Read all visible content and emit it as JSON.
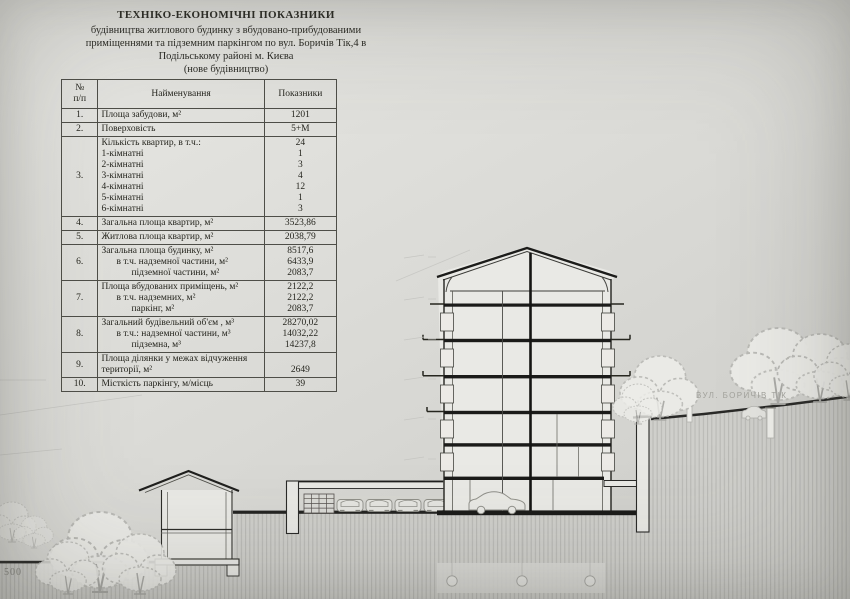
{
  "title": {
    "lines": [
      "ТЕХНІКО-ЕКОНОМІЧНІ ПОКАЗНИКИ",
      "будівництва житлового будинку з вбудовано-прибудованими",
      "приміщеннями та підземним паркінгом по вул. Боричів Тік,4 в",
      "Подільському районі м. Києва",
      "(нове будівництво)"
    ]
  },
  "table": {
    "headers": {
      "no": "№\nп/п",
      "name": "Найменування",
      "value": "Показники"
    },
    "rows": [
      {
        "no": "1.",
        "lines": [
          {
            "label": "Площа забудови, м²",
            "value": "1201"
          }
        ]
      },
      {
        "no": "2.",
        "lines": [
          {
            "label": "Поверховість",
            "value": "5+М"
          }
        ]
      },
      {
        "no": "3.",
        "lines": [
          {
            "label": "Кількість квартир, в т.ч.:",
            "value": "24"
          },
          {
            "label": "1-кімнатні",
            "value": "1"
          },
          {
            "label": "2-кімнатні",
            "value": "3"
          },
          {
            "label": "3-кімнатні",
            "value": "4"
          },
          {
            "label": "4-кімнатні",
            "value": "12"
          },
          {
            "label": "5-кімнатні",
            "value": "1"
          },
          {
            "label": "6-кімнатні",
            "value": "3"
          }
        ]
      },
      {
        "no": "4.",
        "lines": [
          {
            "label": "Загальна площа квартир, м²",
            "value": "3523,86"
          }
        ]
      },
      {
        "no": "5.",
        "lines": [
          {
            "label": "Житлова площа квартир, м²",
            "value": "2038,79"
          }
        ]
      },
      {
        "no": "6.",
        "lines": [
          {
            "label": "Загальна площа будинку, м²",
            "value": "8517,6"
          },
          {
            "label": "в т.ч. надземної частини, м²",
            "value": "6433,9",
            "indent": 1
          },
          {
            "label": "підземної частини, м²",
            "value": "2083,7",
            "indent": 2
          }
        ]
      },
      {
        "no": "7.",
        "lines": [
          {
            "label": "Площа вбудованих приміщень, м²",
            "value": "2122,2"
          },
          {
            "label": "в т.ч. надземних, м²",
            "value": "2122,2",
            "indent": 1
          },
          {
            "label": "паркінг, м²",
            "value": "2083,7",
            "indent": 2
          }
        ]
      },
      {
        "no": "8.",
        "lines": [
          {
            "label": "Загальний будівельний об'єм , м³",
            "value": "28270,02"
          },
          {
            "label": "в т.ч.: надземної частини, м³",
            "value": "14032,22",
            "indent": 1
          },
          {
            "label": "підземна, м³",
            "value": "14237,8",
            "indent": 2
          }
        ]
      },
      {
        "no": "9.",
        "lines": [
          {
            "label": "Площа ділянки у межах відчуження",
            "value": ""
          },
          {
            "label": "території, м²",
            "value": "2649"
          }
        ]
      },
      {
        "no": "10.",
        "lines": [
          {
            "label": "Місткість паркінгу, м/місць",
            "value": "39"
          }
        ]
      }
    ]
  },
  "drawing": {
    "street_label": "ВУЛ. БОРИЧІВ ТІК",
    "scale_label": "500",
    "colors": {
      "ink": "#20201e",
      "hatch_bg": "#cfcfcb",
      "hatch_line": "#b7b7b3",
      "faint": "#c6c6c2",
      "tree": "#b9b9b5"
    }
  }
}
